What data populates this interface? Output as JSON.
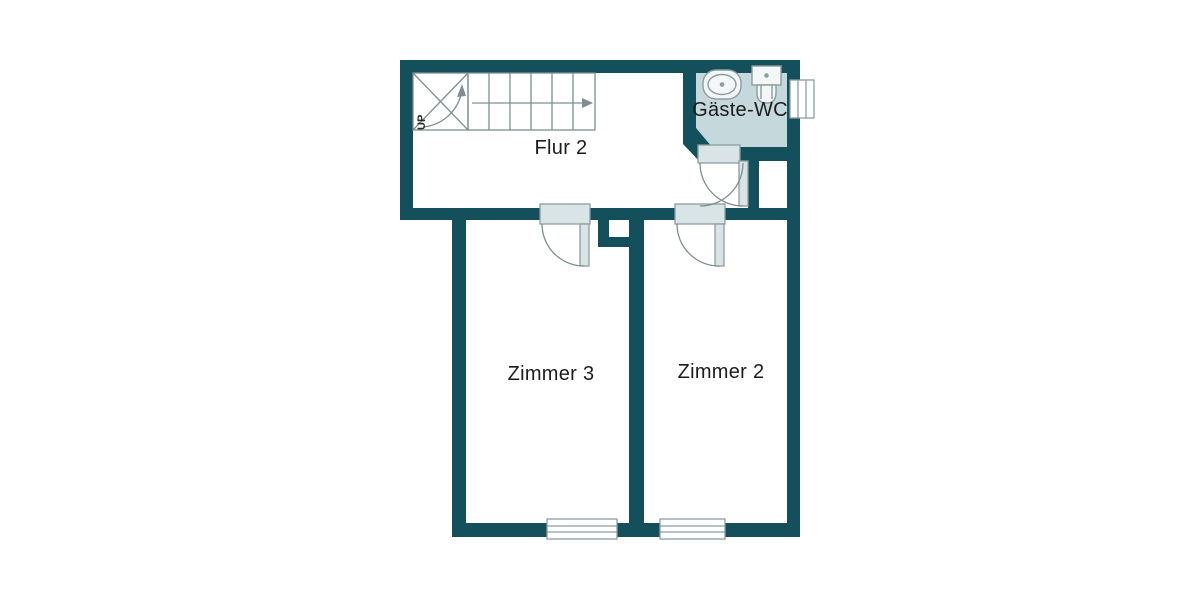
{
  "labels": {
    "hall": "Flur 2",
    "wc": "Gäste-WC",
    "room3": "Zimmer 3",
    "room2": "Zimmer 2",
    "up": "UP"
  },
  "colors": {
    "wall": "#13505b",
    "wc_floor": "#c5d8db",
    "door_fill": "#d8e4e6",
    "door_border": "#8b9da0",
    "line": "#7f8e90",
    "fixture_fill": "#f4f7f7",
    "window_fill": "#ffffff",
    "text": "#1c1c1c",
    "background": "#ffffff"
  }
}
